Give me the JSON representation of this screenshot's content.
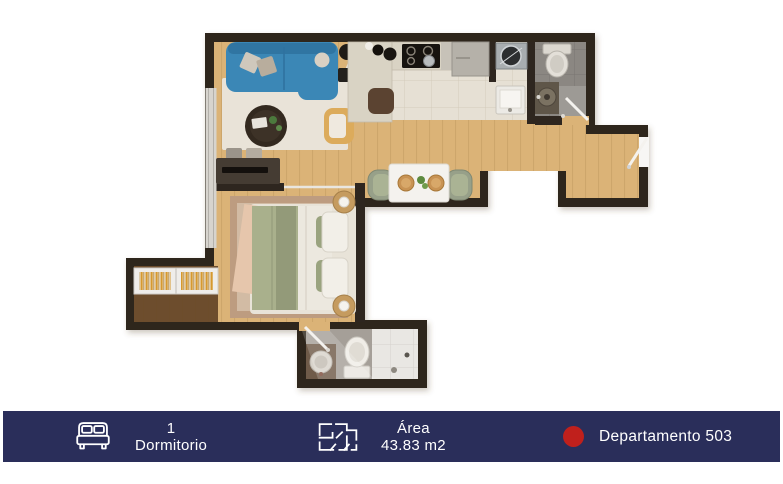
{
  "footer": {
    "items": [
      {
        "icon": "bed-icon",
        "line1": "1",
        "line2": "Dormitorio"
      },
      {
        "icon": "floor-plan-icon",
        "line1": "Área",
        "line2": "43.83 m2"
      },
      {
        "icon": "red-dot-icon",
        "label": "Departamento 503"
      }
    ]
  },
  "colors": {
    "footer_bg": "#2a2e5a",
    "footer_text": "#ffffff",
    "dot_red": "#c0201c",
    "wall": "#2e261f",
    "wood_floor": "#dbb377",
    "sofa_blue": "#3b87b6",
    "armchair_yellow": "#dcab5b",
    "bed_green": "#a9b08c"
  }
}
